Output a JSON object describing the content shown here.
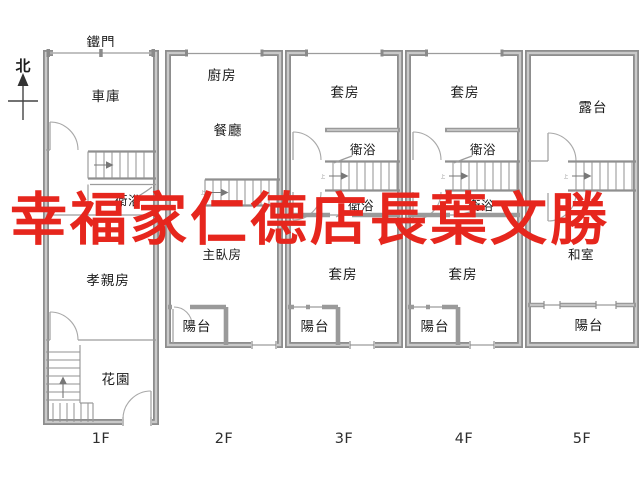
{
  "watermark": {
    "text": "幸福家仁德店長葉文勝",
    "color": "#e6261d"
  },
  "compass": {
    "north_label": "北"
  },
  "top_label": {
    "gate": "鐵門"
  },
  "stairs": {
    "up_label": "上"
  },
  "floors": [
    {
      "label": "1F",
      "rooms": {
        "garage": "車庫",
        "bathroom": "衛浴",
        "parents_room": "孝親房",
        "garden": "花園"
      }
    },
    {
      "label": "2F",
      "rooms": {
        "kitchen": "廚房",
        "dining_room": "餐廳",
        "master_bedroom": "主臥房",
        "balcony": "陽台"
      }
    },
    {
      "label": "3F",
      "rooms": {
        "suite_upper": "套房",
        "bathroom_upper": "衛浴",
        "bathroom_lower": "衛浴",
        "suite_lower": "套房",
        "balcony": "陽台"
      }
    },
    {
      "label": "4F",
      "rooms": {
        "suite_upper": "套房",
        "bathroom_upper": "衛浴",
        "bathroom_lower": "衛浴",
        "suite_lower": "套房",
        "balcony": "陽台"
      }
    },
    {
      "label": "5F",
      "rooms": {
        "terrace": "露台",
        "tatami_room": "和室",
        "balcony": "陽台"
      }
    }
  ]
}
